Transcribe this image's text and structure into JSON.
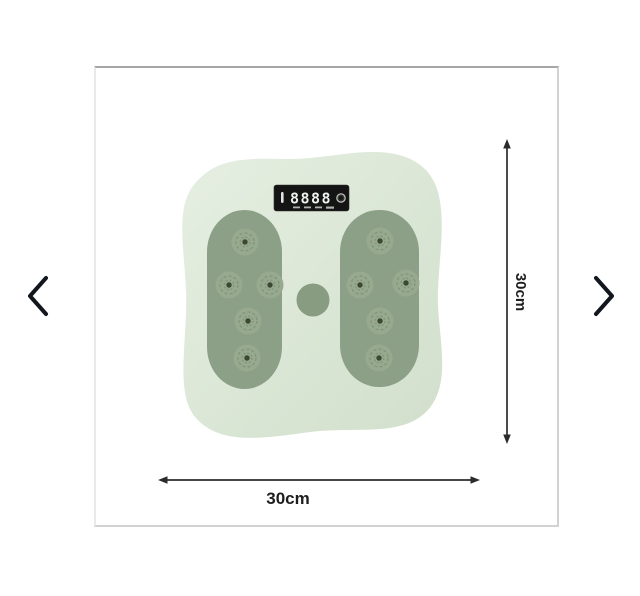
{
  "carousel": {
    "prev_button": "previous-image",
    "next_button": "next-image"
  },
  "product": {
    "description": "green foot massage twist board with reflexology nodes",
    "display": {
      "value": "8888"
    },
    "dimensions": {
      "width": "30cm",
      "height": "30cm"
    }
  },
  "colors": {
    "plate_a": "#e6efe2",
    "plate_b": "#d1dfcb",
    "pad": "#8ca087",
    "node": "#97aa8f",
    "node_pattern": "#758b6f",
    "node_dot": "#3c4834",
    "knob": "#879c81",
    "display_bg": "#141414",
    "digit": "#eef2ee",
    "arrow": "#2b2b2b",
    "label": "#1e1e1e",
    "chevron": "#12161d",
    "frame_border": "#d2d2d2",
    "frame_border_top": "#a6a6a6"
  }
}
